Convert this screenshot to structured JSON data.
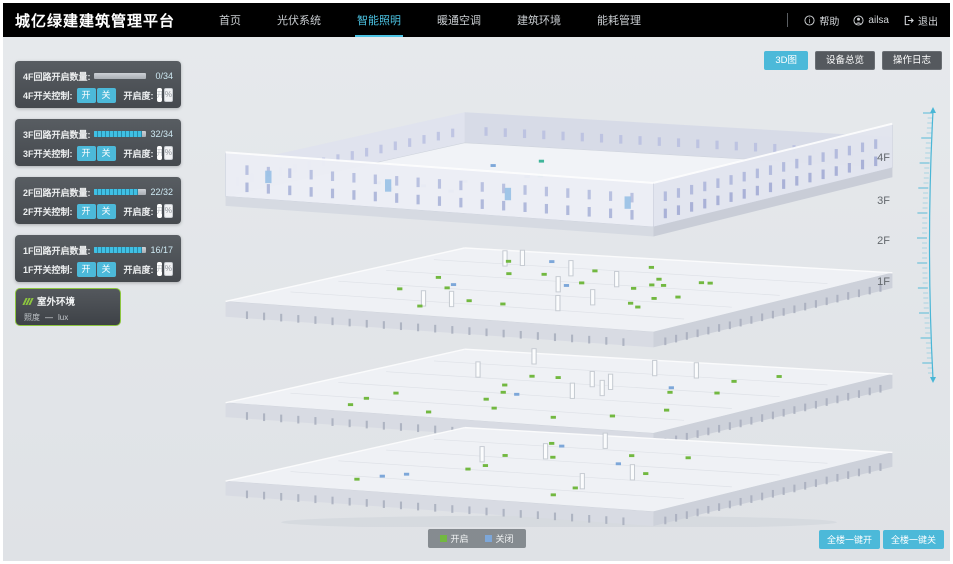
{
  "colors": {
    "accent": "#4cc3e3",
    "button_cyan": "#4cb9d9",
    "light_on_green": "#72b840",
    "light_off_blue": "#7da7d9",
    "outdoor_border_green": "#8dc63f",
    "header_bg": "#000000"
  },
  "header": {
    "title": "城亿绿建建筑管理平台",
    "nav": [
      {
        "label": "首页",
        "active": false
      },
      {
        "label": "光伏系统",
        "active": false
      },
      {
        "label": "智能照明",
        "active": true
      },
      {
        "label": "暖通空调",
        "active": false
      },
      {
        "label": "建筑环境",
        "active": false
      },
      {
        "label": "能耗管理",
        "active": false
      }
    ],
    "actions": {
      "help": "帮助",
      "username": "ailsa",
      "logout": "退出"
    }
  },
  "view_toolbar": {
    "buttons": [
      {
        "label": "3D图",
        "active": true
      },
      {
        "label": "设备总览",
        "active": false
      },
      {
        "label": "操作日志",
        "active": false
      }
    ]
  },
  "floor_panels": [
    {
      "floor": "4F",
      "circuit_label": "4F回路开启数量:",
      "value": "0/34",
      "fill_percent": 0,
      "switch_label": "4F开关控制:",
      "on_label": "开",
      "off_label": "关",
      "dim_label": "开启度:",
      "dim_placeholder": "开启度",
      "percent_label": "%"
    },
    {
      "floor": "3F",
      "circuit_label": "3F回路开启数量:",
      "value": "32/34",
      "fill_percent": 94,
      "switch_label": "3F开关控制:",
      "on_label": "开",
      "off_label": "关",
      "dim_label": "开启度:",
      "dim_placeholder": "开启度",
      "percent_label": "%"
    },
    {
      "floor": "2F",
      "circuit_label": "2F回路开启数量:",
      "value": "22/32",
      "fill_percent": 86,
      "switch_label": "2F开关控制:",
      "on_label": "开",
      "off_label": "关",
      "dim_label": "开启度:",
      "dim_placeholder": "开启度",
      "percent_label": "%"
    },
    {
      "floor": "1F",
      "circuit_label": "1F回路开启数量:",
      "value": "16/17",
      "fill_percent": 94,
      "switch_label": "1F开关控制:",
      "on_label": "开",
      "off_label": "关",
      "dim_label": "开启度:",
      "dim_placeholder": "开启度",
      "percent_label": "%"
    }
  ],
  "outdoor_panel": {
    "title": "室外环境",
    "metric_label": "照度",
    "metric_value": "—",
    "metric_unit": "lux"
  },
  "floor_markers": [
    "4F",
    "3F",
    "2F",
    "1F"
  ],
  "legend": {
    "on_label": "开启",
    "off_label": "关闭"
  },
  "bulk_controls": {
    "all_on": "全楼一键开",
    "all_off": "全楼一键关"
  }
}
